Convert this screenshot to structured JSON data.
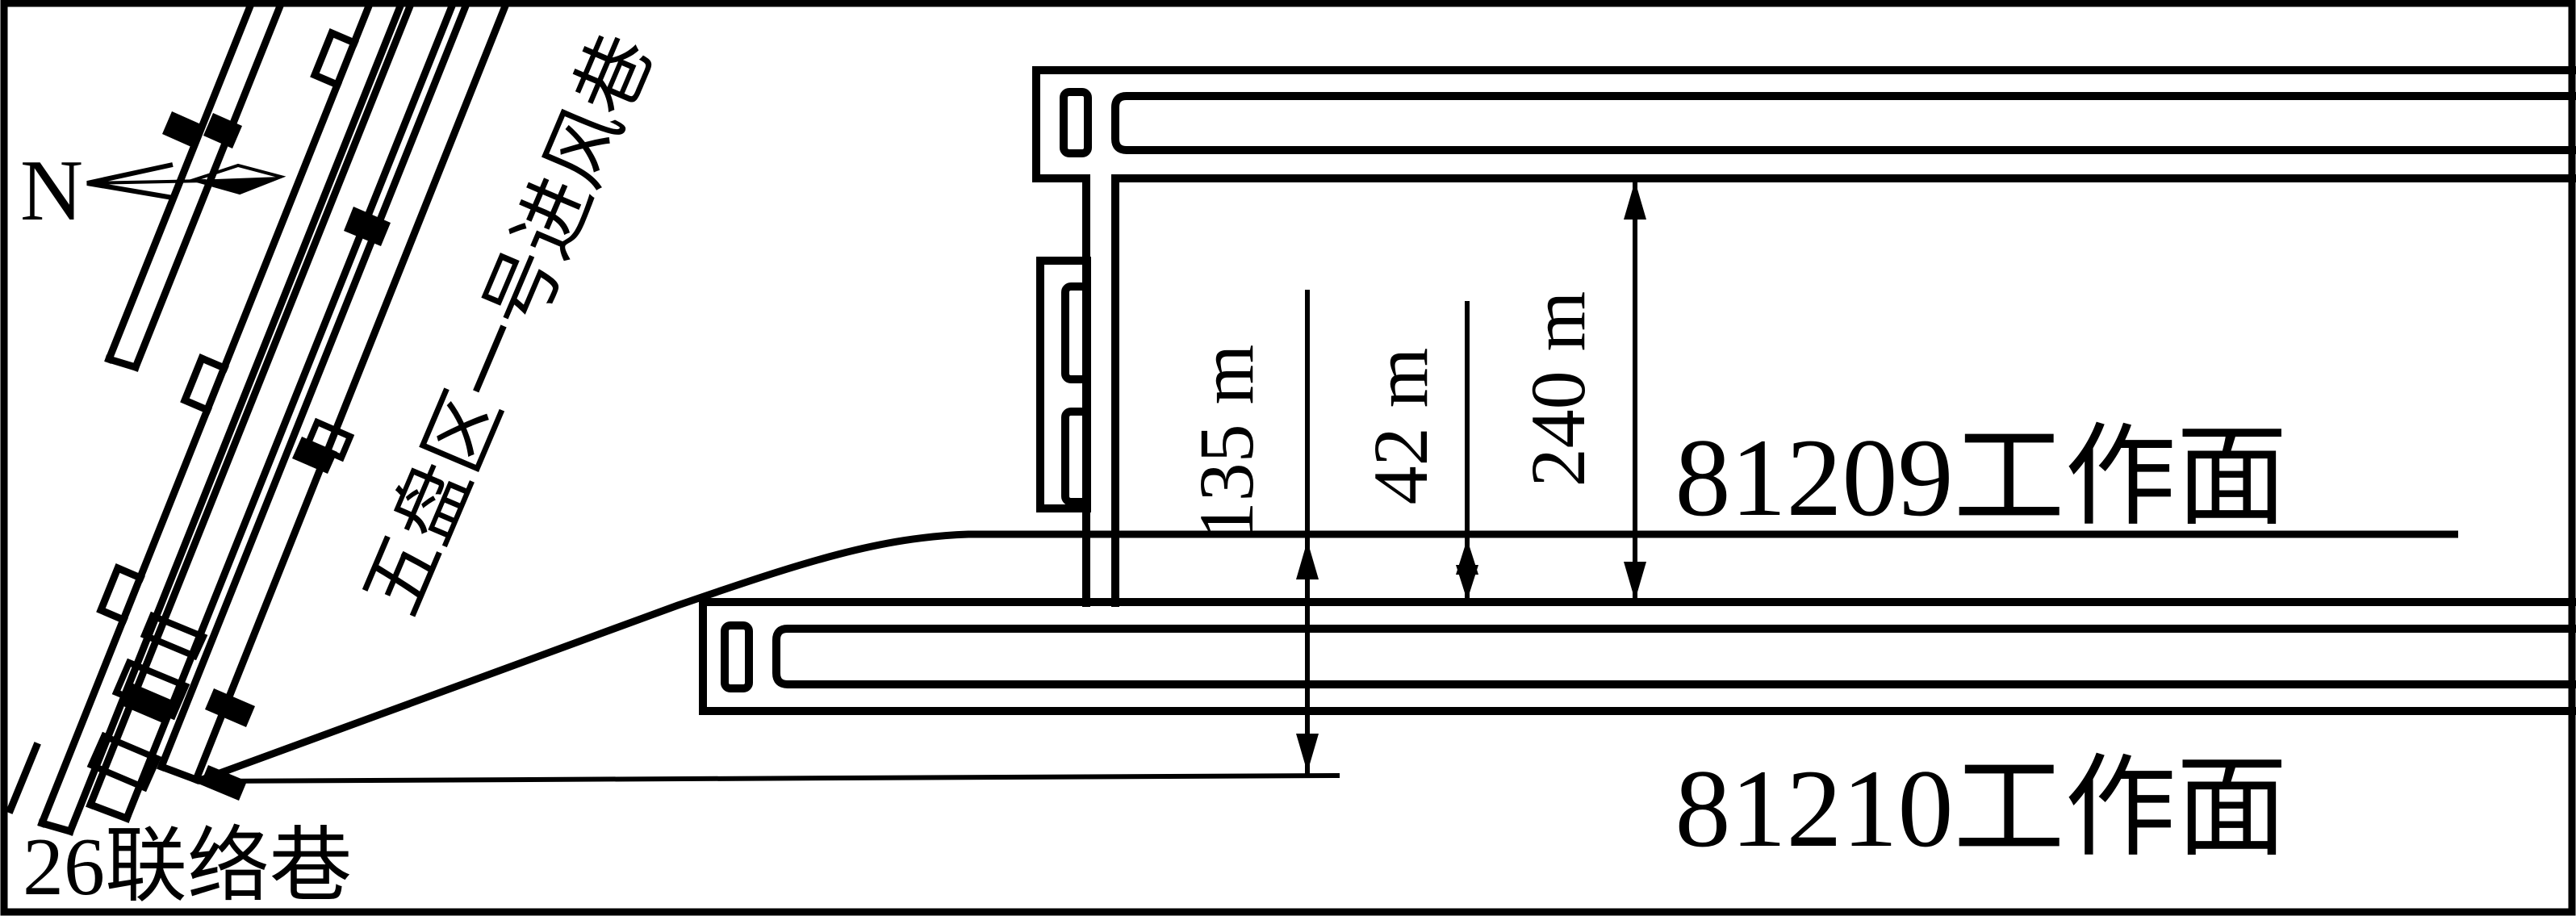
{
  "diagram": {
    "type": "mine-working-face-plan",
    "colors": {
      "ink": "#000000",
      "paper": "#ffffff"
    }
  },
  "labels": {
    "north": "N",
    "inclined_intake_roadway": "五盘区一号进风巷",
    "connection_roadway": "26联络巷",
    "face_81209": "81209工作面",
    "face_81210": "81210工作面"
  },
  "dimensions": {
    "dim_135": "135 m",
    "dim_42": "42 m",
    "dim_240": "240 m"
  }
}
